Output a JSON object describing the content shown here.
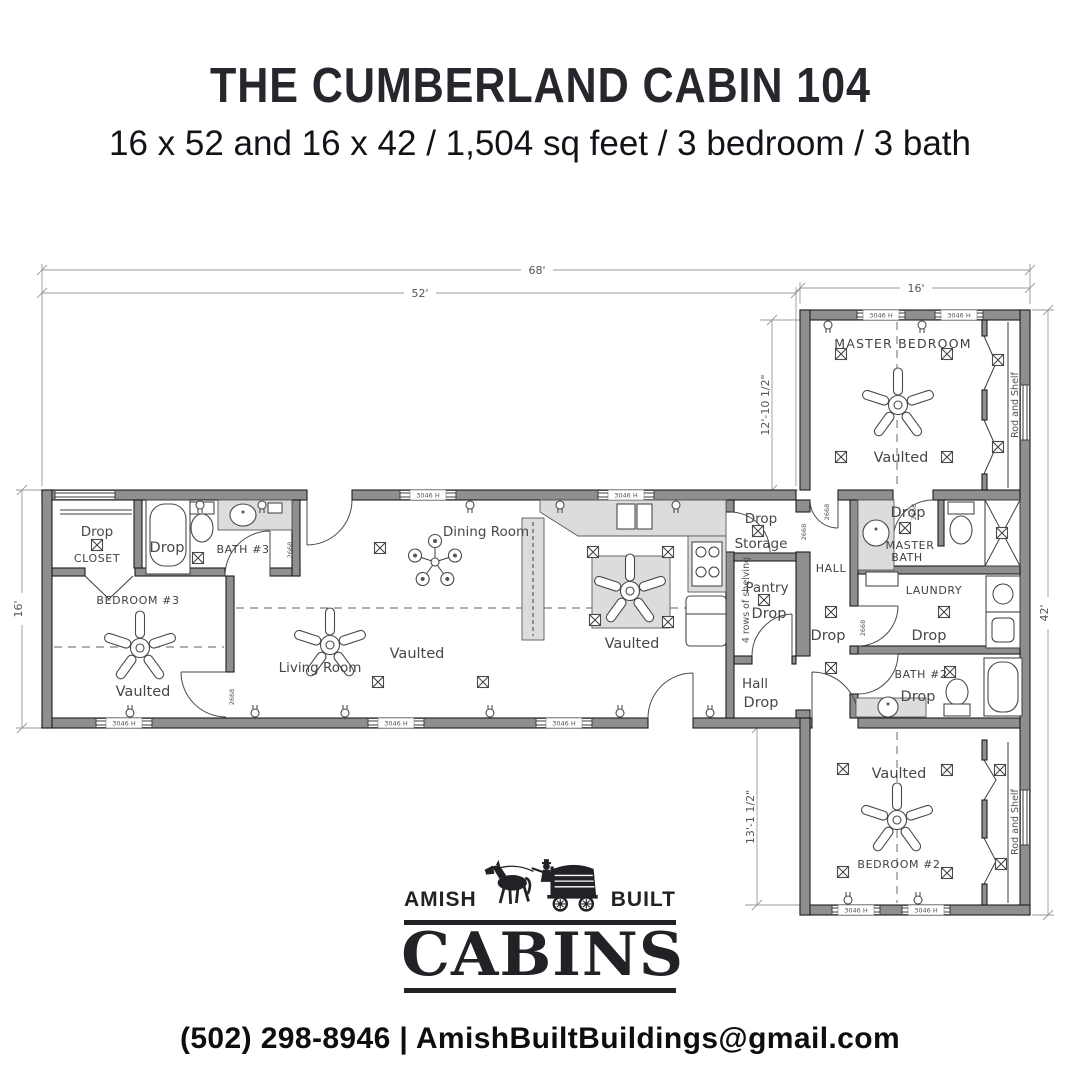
{
  "header": {
    "title": "THE CUMBERLAND CABIN 104",
    "subtitle": "16 x 52 and 16 x 42 / 1,504 sq feet / 3 bedroom / 3 bath"
  },
  "plan": {
    "dimensions": {
      "overall_width": "68'",
      "main_width": "52'",
      "wing_width": "16'",
      "main_depth": "16'",
      "wing_length": "42'",
      "master_depth": "12'-10 1/2\"",
      "bedroom2_depth": "13'-1 1/2\""
    },
    "tags": {
      "window": "3046 H",
      "door": "2668"
    },
    "rooms": {
      "closet": {
        "drop": "Drop",
        "name": "CLOSET"
      },
      "bath3": {
        "drop": "Drop",
        "name": "BATH #3"
      },
      "bedroom3": {
        "name": "BEDROOM #3",
        "ceiling": "Vaulted"
      },
      "living": {
        "name": "Living Room",
        "ceiling": "Vaulted"
      },
      "dining": {
        "name": "Dining Room"
      },
      "kitchen": {
        "ceiling": "Vaulted"
      },
      "storage": {
        "drop": "Drop",
        "name": "Storage"
      },
      "pantry": {
        "name": "Pantry",
        "drop": "Drop",
        "shelving": "4 rows of shelving"
      },
      "hall_main": {
        "name": "Hall",
        "drop": "Drop"
      },
      "hall_wing": {
        "name": "HALL",
        "drop": "Drop"
      },
      "master_bedroom": {
        "name": "MASTER BEDROOM",
        "ceiling": "Vaulted",
        "closet": "Rod and Shelf"
      },
      "master_bath": {
        "drop": "Drop",
        "name_line1": "MASTER",
        "name_line2": "BATH"
      },
      "laundry": {
        "name": "LAUNDRY",
        "drop": "Drop"
      },
      "bath2": {
        "name": "BATH #2",
        "drop": "Drop"
      },
      "bedroom2": {
        "name": "BEDROOM #2",
        "ceiling": "Vaulted",
        "closet": "Rod and Shelf"
      }
    }
  },
  "logo": {
    "word_left": "AMISH",
    "word_right": "BUILT",
    "brand": "CABINS"
  },
  "footer": {
    "contact": "(502) 298-8946 | AmishBuiltBuildings@gmail.com"
  }
}
